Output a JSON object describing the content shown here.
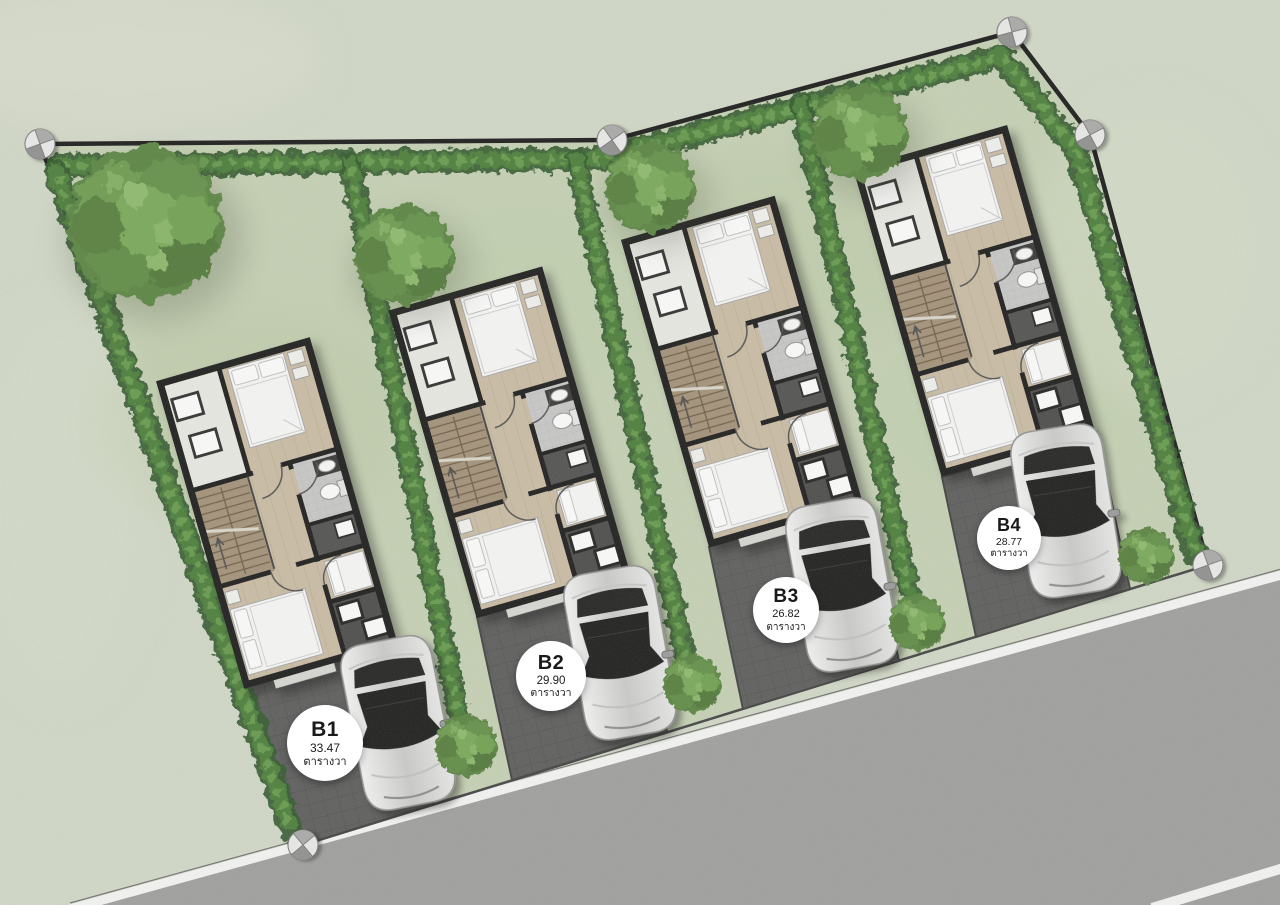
{
  "plots": [
    {
      "id": "B1",
      "area": "33.47",
      "unit": "ตารางวา"
    },
    {
      "id": "B2",
      "area": "29.90",
      "unit": "ตารางวา"
    },
    {
      "id": "B3",
      "area": "26.82",
      "unit": "ตารางวา"
    },
    {
      "id": "B4",
      "area": "28.77",
      "unit": "ตารางวา"
    }
  ],
  "colors": {
    "grass_outer": "#d3dac8",
    "grass_inner": "#c6d2b4",
    "hedge": "#3f6c33",
    "road": "#9e9e9e",
    "road_line": "#f7f7f7",
    "driveway": "#595959",
    "house_wall": "#171717",
    "wood_floor": "#cbbda4",
    "label_bg": "#ffffff",
    "label_text": "#1a1a1a",
    "car_body": "#e8e8e8",
    "car_glass": "#141414"
  }
}
